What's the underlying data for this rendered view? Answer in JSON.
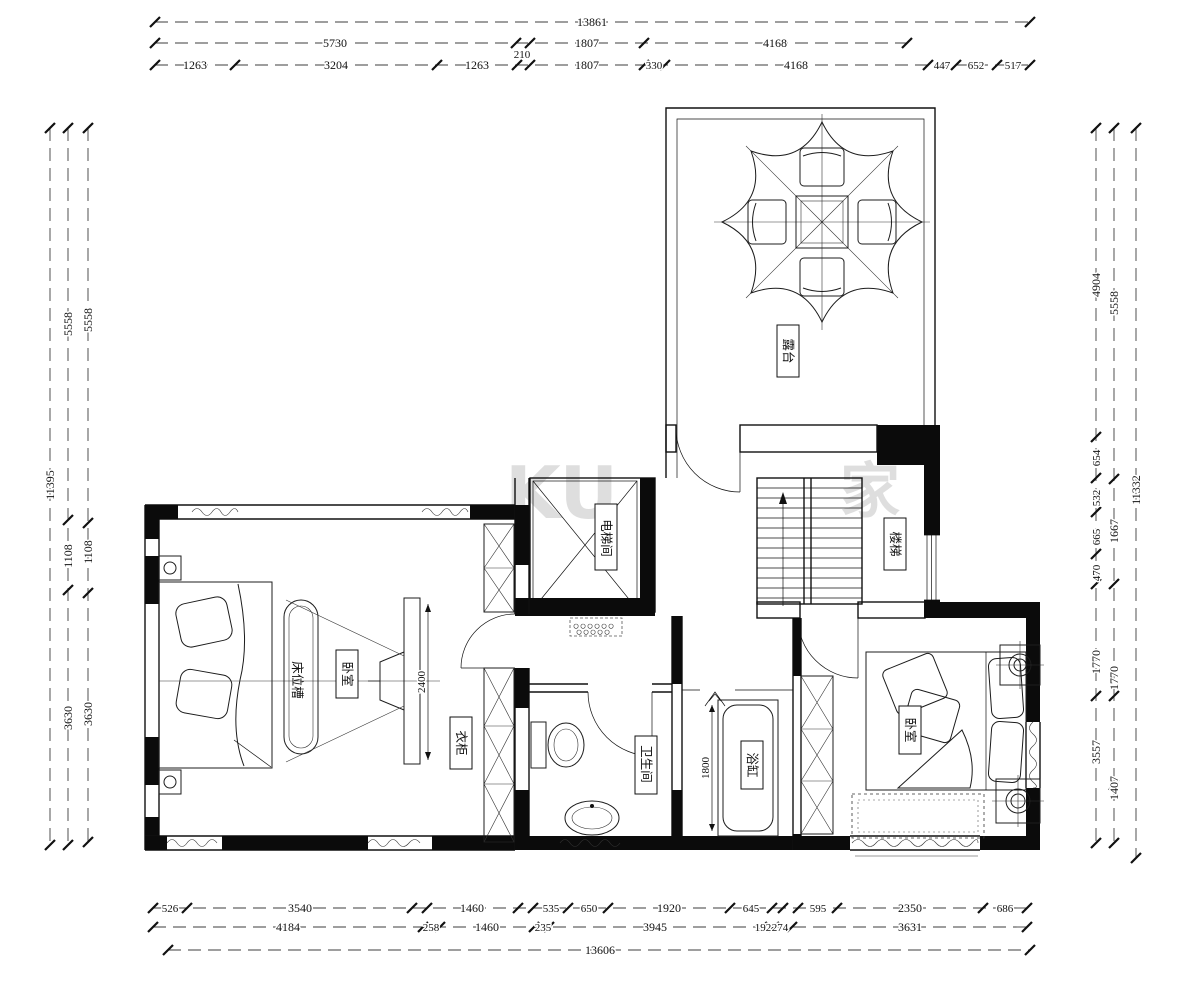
{
  "meta": {
    "drawing_type": "二层平面布置图"
  },
  "watermark": {
    "left": "KU",
    "right": "家"
  },
  "rooms": {
    "balcony": "露台",
    "elevator": "电梯间",
    "stairs": "楼梯",
    "bedroom_left": "卧室",
    "bed_niche": "床位槽",
    "wardrobe": "衣柜",
    "bathroom": "卫生间",
    "bathtub": "浴缸",
    "bedroom_right": "卧室"
  },
  "inline_dims": {
    "tv_wall": "2400",
    "bathtub": "1800"
  },
  "dims": {
    "top": {
      "total": "13861",
      "row2": [
        "5730",
        "210",
        "1807",
        "4168"
      ],
      "row3": [
        "1263",
        "3204",
        "1263",
        "1807",
        "330",
        "4168",
        "447",
        "652",
        "517"
      ]
    },
    "bottom": {
      "row1": [
        "526",
        "3540",
        "1460",
        "535",
        "650",
        "1920",
        "645",
        "595",
        "2350",
        "686"
      ],
      "row2": [
        "4184",
        "258",
        "1460",
        "235",
        "3945",
        "192",
        "274",
        "3631"
      ],
      "total": "13606"
    },
    "left": {
      "total": "11395",
      "mid": [
        "5558",
        "1108",
        "3630"
      ],
      "inner": [
        "5558",
        "1108",
        "3630"
      ]
    },
    "right": {
      "inner": [
        "4904",
        "654",
        "532",
        "665",
        "470",
        "1770",
        "3557"
      ],
      "mid": [
        "5558",
        "1667",
        "1770",
        "1407"
      ],
      "total": "11332"
    }
  },
  "colors": {
    "line": "#111111",
    "wall_fill": "#0b0b0b",
    "dim_line": "#3d3d3d",
    "watermark": "#d6d6d6"
  }
}
